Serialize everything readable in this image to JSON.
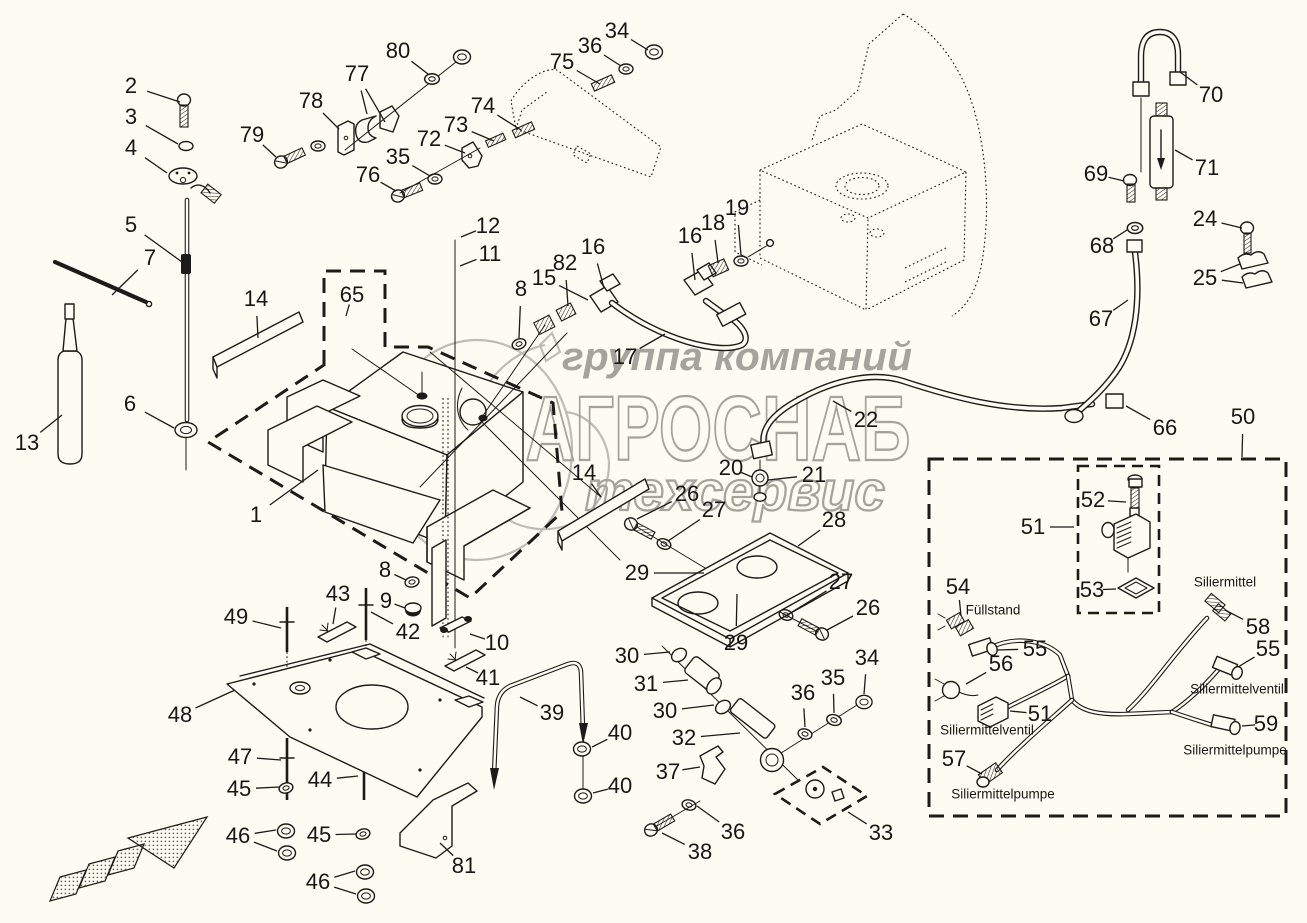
{
  "page": {
    "background": "#fcfcf2"
  },
  "watermark": {
    "line1": "группа компаний",
    "line2": "АГРОСНАБ",
    "line3": "техсервис",
    "color": "#a4a49e"
  },
  "diagram": {
    "type": "exploded-parts-diagram",
    "part_labels": [
      {
        "text": "Füllstand",
        "x": 993,
        "y": 610
      },
      {
        "text": "Siliermittel",
        "x": 1225,
        "y": 582
      },
      {
        "text": "Siliermittelventil",
        "x": 987,
        "y": 730
      },
      {
        "text": "Siliermittelventil",
        "x": 1237,
        "y": 689
      },
      {
        "text": "Siliermittelpumpe",
        "x": 1003,
        "y": 794
      },
      {
        "text": "Siliermittelpumpe",
        "x": 1235,
        "y": 750
      }
    ],
    "callouts": [
      {
        "n": "1",
        "x": 256,
        "y": 515,
        "t": [
          [
            318,
            470
          ]
        ]
      },
      {
        "n": "2",
        "x": 131,
        "y": 86,
        "t": [
          [
            180,
            102
          ]
        ]
      },
      {
        "n": "3",
        "x": 131,
        "y": 117,
        "t": [
          [
            178,
            144
          ]
        ]
      },
      {
        "n": "4",
        "x": 131,
        "y": 148,
        "t": [
          [
            167,
            173
          ]
        ]
      },
      {
        "n": "5",
        "x": 131,
        "y": 225,
        "t": [
          [
            182,
            262
          ]
        ]
      },
      {
        "n": "6",
        "x": 130,
        "y": 404,
        "t": [
          [
            174,
            428
          ]
        ]
      },
      {
        "n": "7",
        "x": 150,
        "y": 258,
        "t": [
          [
            112,
            295
          ]
        ]
      },
      {
        "n": "8",
        "x": 521,
        "y": 289,
        "t": [
          [
            519,
            338
          ]
        ]
      },
      {
        "n": "8",
        "x": 385,
        "y": 570,
        "t": [
          [
            406,
            580
          ]
        ]
      },
      {
        "n": "9",
        "x": 386,
        "y": 601,
        "t": [
          [
            405,
            608
          ]
        ]
      },
      {
        "n": "10",
        "x": 497,
        "y": 643,
        "t": [
          [
            470,
            634
          ]
        ]
      },
      {
        "n": "11",
        "x": 490,
        "y": 254,
        "t": [
          [
            460,
            266
          ]
        ]
      },
      {
        "n": "12",
        "x": 488,
        "y": 226,
        "t": [
          [
            461,
            237
          ]
        ]
      },
      {
        "n": "13",
        "x": 27,
        "y": 443,
        "t": [
          [
            62,
            415
          ]
        ]
      },
      {
        "n": "14",
        "x": 256,
        "y": 299,
        "t": [
          [
            258,
            338
          ]
        ]
      },
      {
        "n": "14",
        "x": 584,
        "y": 473,
        "t": [
          [
            601,
            497
          ]
        ]
      },
      {
        "n": "15",
        "x": 544,
        "y": 278,
        "t": [
          [
            588,
            300
          ]
        ]
      },
      {
        "n": "16",
        "x": 593,
        "y": 247,
        "t": [
          [
            604,
            288
          ]
        ]
      },
      {
        "n": "16",
        "x": 690,
        "y": 236,
        "t": [
          [
            695,
            280
          ]
        ]
      },
      {
        "n": "17",
        "x": 625,
        "y": 357,
        "t": [
          [
            665,
            334
          ]
        ]
      },
      {
        "n": "18",
        "x": 713,
        "y": 223,
        "t": [
          [
            718,
            263
          ]
        ]
      },
      {
        "n": "19",
        "x": 737,
        "y": 208,
        "t": [
          [
            741,
            255
          ]
        ]
      },
      {
        "n": "20",
        "x": 731,
        "y": 468,
        "t": [
          [
            752,
            477
          ]
        ]
      },
      {
        "n": "21",
        "x": 814,
        "y": 475,
        "t": [
          [
            768,
            480
          ]
        ]
      },
      {
        "n": "22",
        "x": 866,
        "y": 420,
        "t": [
          [
            833,
            401
          ]
        ]
      },
      {
        "n": "24",
        "x": 1205,
        "y": 219,
        "t": [
          [
            1242,
            228
          ]
        ]
      },
      {
        "n": "25",
        "x": 1205,
        "y": 278,
        "t": [
          [
            1240,
            264
          ],
          [
            1243,
            283
          ]
        ]
      },
      {
        "n": "26",
        "x": 687,
        "y": 494,
        "t": [
          [
            637,
            519
          ]
        ]
      },
      {
        "n": "27",
        "x": 714,
        "y": 510,
        "t": [
          [
            668,
            541
          ]
        ]
      },
      {
        "n": "28",
        "x": 834,
        "y": 520,
        "t": [
          [
            798,
            546
          ]
        ]
      },
      {
        "n": "29",
        "x": 637,
        "y": 573,
        "t": [
          [
            704,
            573
          ]
        ]
      },
      {
        "n": "27",
        "x": 841,
        "y": 582,
        "t": [
          [
            792,
            612
          ]
        ]
      },
      {
        "n": "26",
        "x": 868,
        "y": 608,
        "t": [
          [
            827,
            630
          ]
        ]
      },
      {
        "n": "29",
        "x": 736,
        "y": 643,
        "t": [
          [
            737,
            594
          ]
        ]
      },
      {
        "n": "30",
        "x": 627,
        "y": 656,
        "t": [
          [
            670,
            652
          ]
        ]
      },
      {
        "n": "31",
        "x": 646,
        "y": 684,
        "t": [
          [
            688,
            680
          ]
        ]
      },
      {
        "n": "30",
        "x": 665,
        "y": 711,
        "t": [
          [
            714,
            705
          ]
        ]
      },
      {
        "n": "32",
        "x": 684,
        "y": 738,
        "t": [
          [
            740,
            733
          ]
        ]
      },
      {
        "n": "33",
        "x": 881,
        "y": 833,
        "t": [
          [
            848,
            812
          ]
        ]
      },
      {
        "n": "34",
        "x": 617,
        "y": 31,
        "t": [
          [
            648,
            50
          ]
        ]
      },
      {
        "n": "34",
        "x": 867,
        "y": 658,
        "t": [
          [
            864,
            694
          ]
        ]
      },
      {
        "n": "35",
        "x": 398,
        "y": 157,
        "t": [
          [
            430,
            176
          ]
        ]
      },
      {
        "n": "35",
        "x": 833,
        "y": 678,
        "t": [
          [
            834,
            713
          ]
        ]
      },
      {
        "n": "36",
        "x": 590,
        "y": 46,
        "t": [
          [
            621,
            66
          ]
        ]
      },
      {
        "n": "36",
        "x": 803,
        "y": 693,
        "t": [
          [
            805,
            727
          ]
        ]
      },
      {
        "n": "36",
        "x": 733,
        "y": 832,
        "t": [
          [
            697,
            806
          ]
        ]
      },
      {
        "n": "37",
        "x": 668,
        "y": 772,
        "t": [
          [
            700,
            767
          ]
        ]
      },
      {
        "n": "38",
        "x": 700,
        "y": 852,
        "t": [
          [
            662,
            833
          ]
        ]
      },
      {
        "n": "39",
        "x": 552,
        "y": 713,
        "t": [
          [
            520,
            697
          ]
        ]
      },
      {
        "n": "40",
        "x": 620,
        "y": 733,
        "t": [
          [
            592,
            747
          ]
        ]
      },
      {
        "n": "40",
        "x": 620,
        "y": 786,
        "t": [
          [
            593,
            793
          ]
        ]
      },
      {
        "n": "41",
        "x": 488,
        "y": 678,
        "t": [
          [
            466,
            667
          ]
        ]
      },
      {
        "n": "42",
        "x": 408,
        "y": 632,
        "t": [
          [
            371,
            612
          ]
        ]
      },
      {
        "n": "43",
        "x": 338,
        "y": 594,
        "t": [
          [
            333,
            624
          ]
        ]
      },
      {
        "n": "44",
        "x": 320,
        "y": 780,
        "t": [
          [
            358,
            776
          ]
        ]
      },
      {
        "n": "45",
        "x": 239,
        "y": 789,
        "t": [
          [
            279,
            787
          ]
        ]
      },
      {
        "n": "45",
        "x": 319,
        "y": 835,
        "t": [
          [
            356,
            834
          ]
        ]
      },
      {
        "n": "46",
        "x": 238,
        "y": 836,
        "t": [
          [
            276,
            830
          ],
          [
            277,
            851
          ]
        ]
      },
      {
        "n": "46",
        "x": 318,
        "y": 882,
        "t": [
          [
            355,
            871
          ],
          [
            356,
            894
          ]
        ]
      },
      {
        "n": "47",
        "x": 240,
        "y": 757,
        "t": [
          [
            281,
            760
          ]
        ]
      },
      {
        "n": "48",
        "x": 180,
        "y": 715,
        "t": [
          [
            235,
            690
          ]
        ]
      },
      {
        "n": "49",
        "x": 236,
        "y": 617,
        "t": [
          [
            281,
            628
          ]
        ]
      },
      {
        "n": "50",
        "x": 1243,
        "y": 417,
        "t": [
          [
            1242,
            457
          ]
        ]
      },
      {
        "n": "51",
        "x": 1033,
        "y": 527,
        "t": [
          [
            1074,
            527
          ]
        ]
      },
      {
        "n": "51",
        "x": 1040,
        "y": 714,
        "t": [
          [
            1010,
            711
          ]
        ]
      },
      {
        "n": "52",
        "x": 1093,
        "y": 500,
        "t": [
          [
            1126,
            502
          ]
        ]
      },
      {
        "n": "53",
        "x": 1092,
        "y": 590,
        "t": [
          [
            1116,
            589
          ]
        ]
      },
      {
        "n": "54",
        "x": 958,
        "y": 587,
        "t": [
          [
            961,
            616
          ]
        ]
      },
      {
        "n": "55",
        "x": 1035,
        "y": 649,
        "t": [
          [
            997,
            650
          ]
        ]
      },
      {
        "n": "55",
        "x": 1268,
        "y": 649,
        "t": [
          [
            1238,
            667
          ]
        ]
      },
      {
        "n": "56",
        "x": 1001,
        "y": 664,
        "t": [
          [
            966,
            684
          ]
        ]
      },
      {
        "n": "57",
        "x": 954,
        "y": 759,
        "t": [
          [
            982,
            774
          ]
        ]
      },
      {
        "n": "58",
        "x": 1258,
        "y": 627,
        "t": [
          [
            1225,
            610
          ]
        ]
      },
      {
        "n": "59",
        "x": 1266,
        "y": 724,
        "t": [
          [
            1242,
            726
          ]
        ]
      },
      {
        "n": "65",
        "x": 352,
        "y": 295,
        "t": [
          [
            346,
            316
          ]
        ]
      },
      {
        "n": "66",
        "x": 1165,
        "y": 428,
        "t": [
          [
            1126,
            406
          ]
        ]
      },
      {
        "n": "67",
        "x": 1101,
        "y": 319,
        "t": [
          [
            1128,
            300
          ]
        ]
      },
      {
        "n": "68",
        "x": 1102,
        "y": 246,
        "t": [
          [
            1127,
            230
          ]
        ]
      },
      {
        "n": "69",
        "x": 1096,
        "y": 174,
        "t": [
          [
            1124,
            181
          ]
        ]
      },
      {
        "n": "70",
        "x": 1211,
        "y": 95,
        "t": [
          [
            1180,
            72
          ]
        ]
      },
      {
        "n": "71",
        "x": 1207,
        "y": 168,
        "t": [
          [
            1175,
            150
          ]
        ]
      },
      {
        "n": "72",
        "x": 429,
        "y": 139,
        "t": [
          [
            465,
            153
          ]
        ]
      },
      {
        "n": "73",
        "x": 456,
        "y": 125,
        "t": [
          [
            494,
            141
          ]
        ]
      },
      {
        "n": "74",
        "x": 483,
        "y": 106,
        "t": [
          [
            521,
            130
          ]
        ]
      },
      {
        "n": "75",
        "x": 562,
        "y": 62,
        "t": [
          [
            600,
            84
          ]
        ]
      },
      {
        "n": "76",
        "x": 368,
        "y": 175,
        "t": [
          [
            396,
            191
          ]
        ]
      },
      {
        "n": "77",
        "x": 357,
        "y": 74,
        "t": [
          [
            367,
            114
          ],
          [
            385,
            122
          ]
        ]
      },
      {
        "n": "78",
        "x": 311,
        "y": 101,
        "t": [
          [
            339,
            129
          ]
        ]
      },
      {
        "n": "79",
        "x": 252,
        "y": 135,
        "t": [
          [
            276,
            157
          ]
        ]
      },
      {
        "n": "80",
        "x": 398,
        "y": 51,
        "t": [
          [
            428,
            74
          ]
        ]
      },
      {
        "n": "81",
        "x": 464,
        "y": 866,
        "t": [
          [
            440,
            843
          ]
        ]
      },
      {
        "n": "82",
        "x": 565,
        "y": 263,
        "t": [
          [
            568,
            306
          ]
        ]
      }
    ]
  }
}
